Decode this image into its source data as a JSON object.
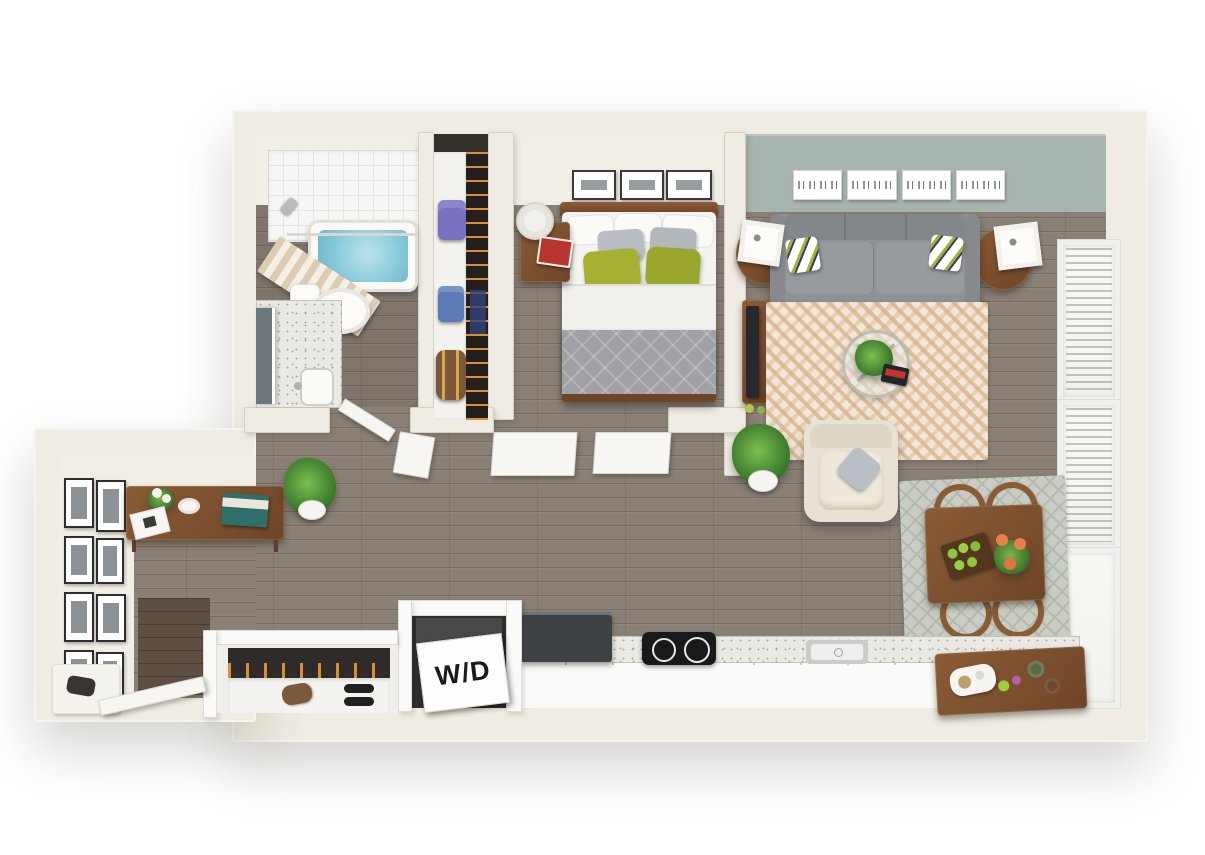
{
  "labels": {
    "washer_dryer": "W/D"
  },
  "colors": {
    "wall": "#efece3",
    "wall_face": "#f1eee5",
    "floor": "#8a8076",
    "sage": "#a8b5af",
    "wood": "#8a5c36",
    "wood_dark": "#6e4527",
    "sofa": "#8f9294",
    "rug_cream": "#f1e6d7",
    "rug_stripe": "#d6b58a",
    "rug_dining": "#c9cdc4",
    "appliance": "#3f4245",
    "water": "#86c8d8",
    "green_pillow": "#a6b134",
    "counter": "#ebe9e3"
  },
  "rooms": [
    {
      "name": "bathroom",
      "items": [
        "bathtub",
        "shower-curtain",
        "shower-head",
        "toilet",
        "vanity-sink",
        "mirror"
      ]
    },
    {
      "name": "closet",
      "items": [
        "shelf",
        "purple-bag",
        "blue-bag",
        "duffel-bag",
        "hanging-clothes"
      ]
    },
    {
      "name": "bedroom",
      "items": [
        "double-bed",
        "green-accent-pillows",
        "nightstand",
        "table-lamp",
        "books",
        "three-frame-wall-art"
      ]
    },
    {
      "name": "living-room",
      "items": [
        "sofa",
        "accent-pillows",
        "four-panel-skyline-art",
        "round-side-tables",
        "cube-lamps",
        "chevron-rug",
        "glass-coffee-table",
        "potted-plant",
        "armchair",
        "tv-console",
        "tv"
      ]
    },
    {
      "name": "dining-area",
      "items": [
        "wood-table",
        "four-hoop-chairs",
        "patterned-rug",
        "apple-tray",
        "orange-flowers"
      ]
    },
    {
      "name": "kitchen",
      "items": [
        "refrigerator",
        "two-burner-cooktop",
        "sink",
        "speckled-counter",
        "bar-console"
      ]
    },
    {
      "name": "laundry-closet",
      "items": [
        "stacked-washer-dryer"
      ]
    },
    {
      "name": "entry",
      "items": [
        "gallery-wall",
        "console-table",
        "potted-plant",
        "coat-closet",
        "shoe-shelf",
        "boot-tray",
        "entry-door"
      ]
    }
  ]
}
